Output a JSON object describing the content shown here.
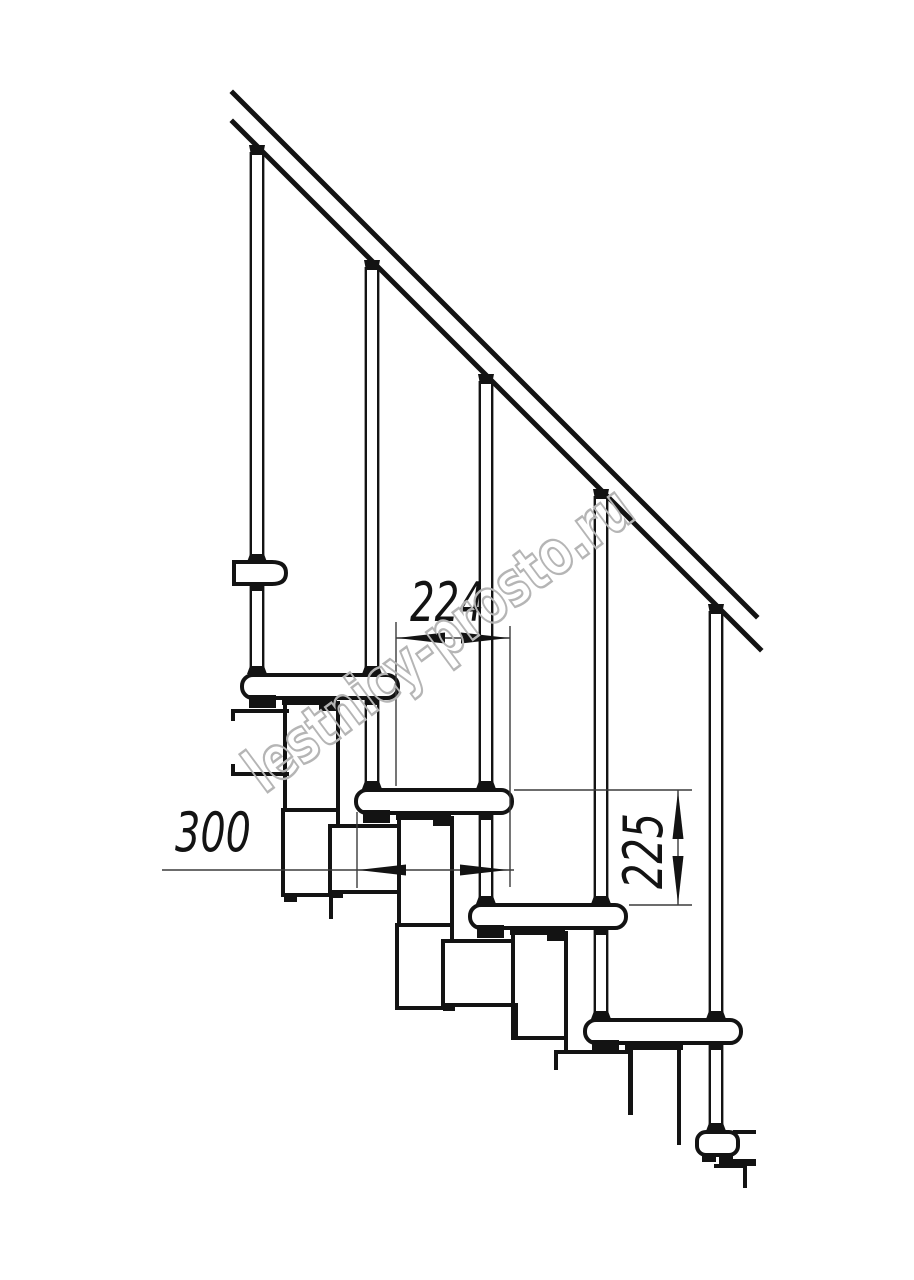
{
  "drawing": {
    "type": "staircase-side-view-technical-drawing",
    "structure": {
      "balusters": 5,
      "treads": 4
    }
  },
  "dimensions": {
    "going": "224",
    "tread_depth": "300",
    "riser_height": "225"
  },
  "watermark": {
    "text": "lestnicy-prosto.ru",
    "color": "#b5b5b5"
  },
  "style": {
    "line_color": "#131313",
    "thin_line_color": "#3b3b3b",
    "background": "#ffffff"
  }
}
